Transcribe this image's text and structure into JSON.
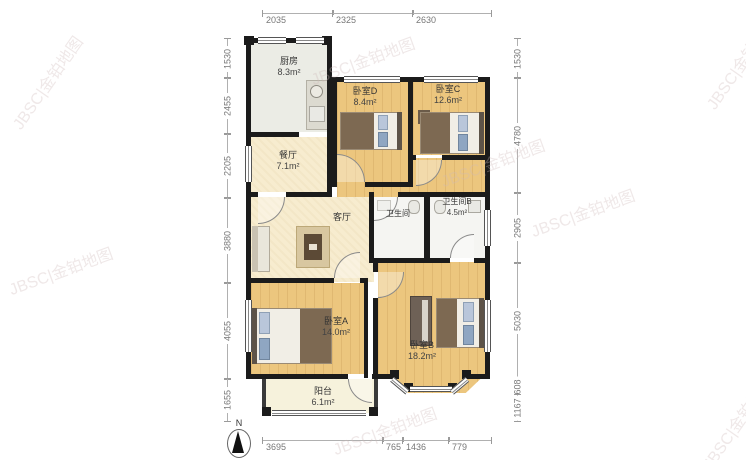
{
  "meta": {
    "compass_label": "N",
    "watermark": "JBSC|金铂地图"
  },
  "rooms": {
    "kitchen": {
      "name": "厨房",
      "area": "8.3m²"
    },
    "bedroom_d": {
      "name": "卧室D",
      "area": "8.4m²"
    },
    "bedroom_c": {
      "name": "卧室C",
      "area": "12.6m²"
    },
    "dining": {
      "name": "餐厅",
      "area": "7.1m²"
    },
    "living": {
      "name": "客厅"
    },
    "bathroom": {
      "name": "卫生间"
    },
    "bathroom_b": {
      "name": "卫生间B",
      "area": "4.5m²"
    },
    "bedroom_a": {
      "name": "卧室A",
      "area": "14.0m²"
    },
    "bedroom_b": {
      "name": "卧室B",
      "area": "18.2m²"
    },
    "balcony": {
      "name": "阳台",
      "area": "6.1m²"
    }
  },
  "dimensions": {
    "top": [
      "2035",
      "2325",
      "2630"
    ],
    "bottom": [
      "3695",
      "765",
      "1436",
      "779"
    ],
    "left": [
      "1530",
      "2455",
      "2205",
      "3880",
      "4055",
      "1655"
    ],
    "right": [
      "1530",
      "4780",
      "2905",
      "5030",
      "608",
      "1167"
    ]
  },
  "colors": {
    "wall": "#1b1b1b",
    "wood_floor": "#ecc67e",
    "cream_floor": "#f7eccf",
    "kitchen_floor": "#ebece5",
    "bath_floor": "#f5f5f2",
    "balcony_floor": "#f6f2dc"
  }
}
